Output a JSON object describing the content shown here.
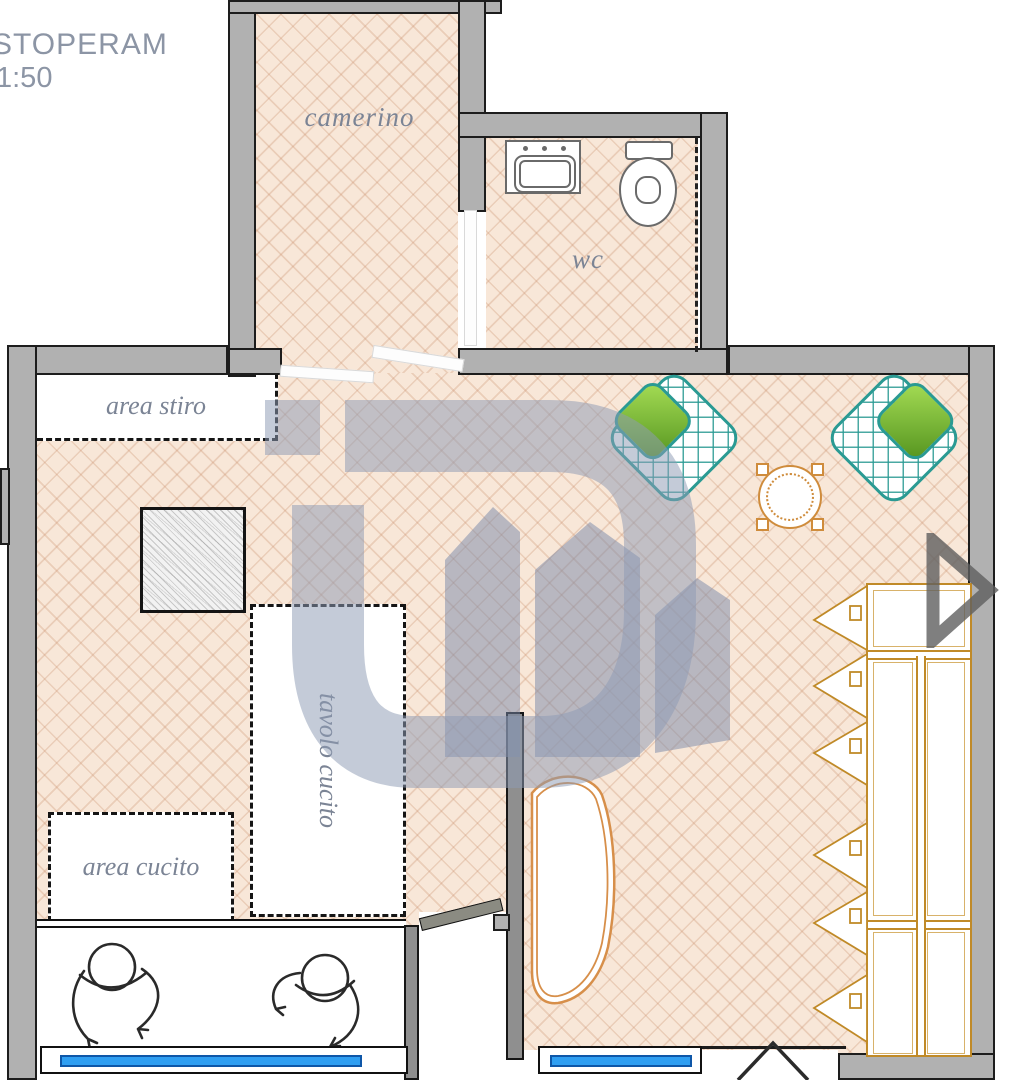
{
  "header": {
    "title": "STOPERAM",
    "scale": "1:50"
  },
  "rooms": {
    "camerino": {
      "label": "camerino"
    },
    "wc": {
      "label": "wc"
    }
  },
  "zones": {
    "area_stiro": {
      "label": "area stiro"
    },
    "tavolo_cucito": {
      "label": "tavolo cucito"
    },
    "area_cucito": {
      "label": "area cucito"
    }
  },
  "colors": {
    "wall_gray": "#b1b1b1",
    "partition_gray": "#8f8f8f",
    "floor_peach": "#f8e7d8",
    "floor_line": "#cb9270",
    "label_gray_blue": "#7b8495",
    "watermark_blue": "#8d9bb4",
    "teal_chair": "#2a9a93",
    "green_cushion": "#7cb93e",
    "orange_furniture": "#c08a28",
    "window_blue": "#2f9ff2",
    "arrow_gray": "#646464"
  }
}
